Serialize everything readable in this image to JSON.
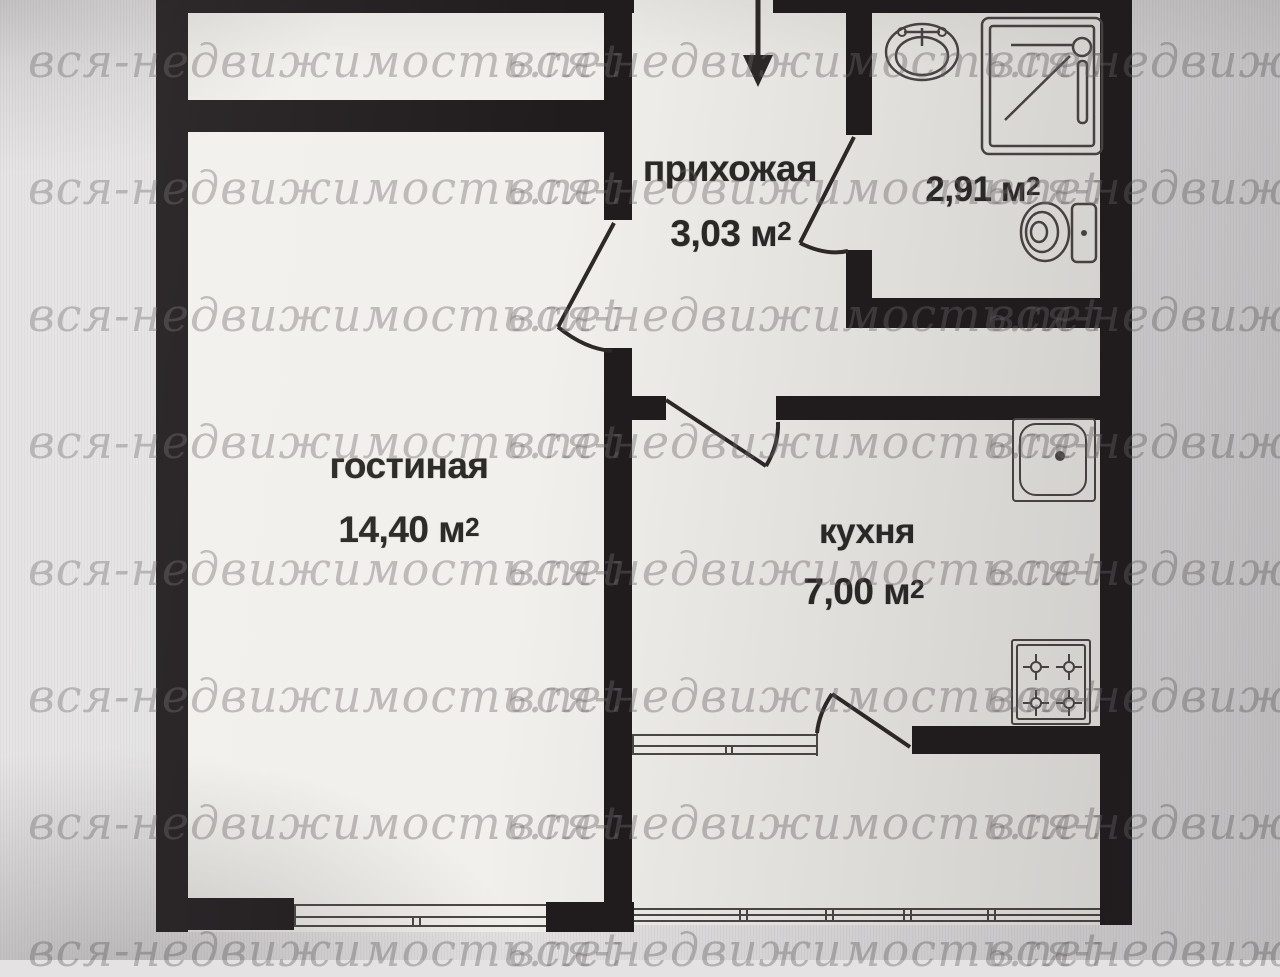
{
  "watermark": {
    "text": "вся-недвижимость.net"
  },
  "rooms": {
    "hallway": {
      "name": "прихожая",
      "area": "3,03 м",
      "area_sup": "2"
    },
    "bathroom": {
      "area": "2,91 м",
      "area_sup": "2"
    },
    "living": {
      "name": "гостиная",
      "area": "14,40 м",
      "area_sup": "2"
    },
    "kitchen": {
      "name": "кухня",
      "area": "7,00 м",
      "area_sup": "2"
    }
  },
  "entrance": {
    "symbol": "entrance-arrow"
  },
  "fixtures": {
    "bathroom": [
      "washbasin",
      "shower-cabin",
      "toilet"
    ],
    "kitchen": [
      "sink",
      "stove"
    ]
  },
  "colors": {
    "wall": "#201c1e",
    "floor": "#f2f0ec",
    "bg": "#e4e2e3",
    "label": "#2b2926",
    "watermark": "#6f696c",
    "line": "#4b4745",
    "door": "#2d2927"
  }
}
